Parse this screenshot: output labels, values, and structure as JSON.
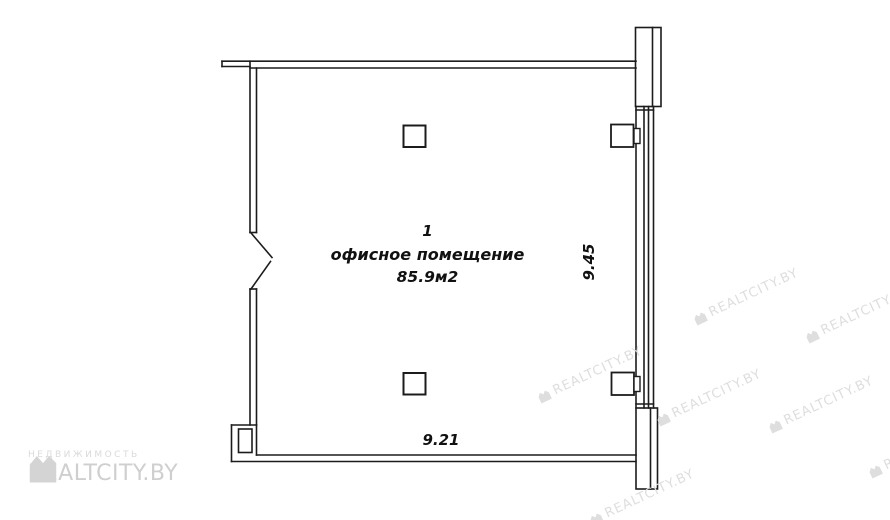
{
  "plan": {
    "room": {
      "number": "1",
      "type_label": "офисное помещение",
      "area_label": "85.9м2"
    },
    "dimensions": {
      "width_m": "9.21",
      "height_m": "9.45"
    }
  },
  "branding": {
    "tagline": "НЕДВИЖИМОСТЬ",
    "logo_text": "REALTCITY.BY",
    "watermark_text": "REALTCITY.BY"
  },
  "colors": {
    "line": "#1c1c1c",
    "watermark": "#dedede",
    "logo": "#cfcfcf",
    "background": "#ffffff"
  }
}
